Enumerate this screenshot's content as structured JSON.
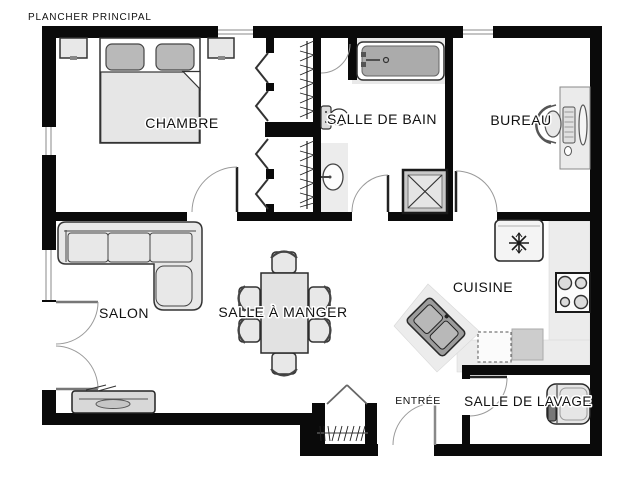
{
  "title": "PLANCHER PRINCIPAL",
  "rooms": {
    "chambre": {
      "label": "CHAMBRE"
    },
    "salle_de_bain": {
      "label": "SALLE DE BAIN"
    },
    "bureau": {
      "label": "BUREAU"
    },
    "salon": {
      "label": "SALON"
    },
    "salle_a_manger": {
      "label": "SALLE À MANGER"
    },
    "cuisine": {
      "label": "CUISINE"
    },
    "entree": {
      "label": "ENTRÉE"
    },
    "salle_de_lavage": {
      "label": "SALLE DE LAVAGE"
    }
  },
  "colors": {
    "wall": "#0a0a0a",
    "background": "#ffffff",
    "furniture_fill": "#e8e8e8",
    "counter_fill": "#ececec",
    "fixture_dark": "#a8a8a8",
    "door_arc": "#9a9a9a",
    "label_text": "#111111"
  }
}
